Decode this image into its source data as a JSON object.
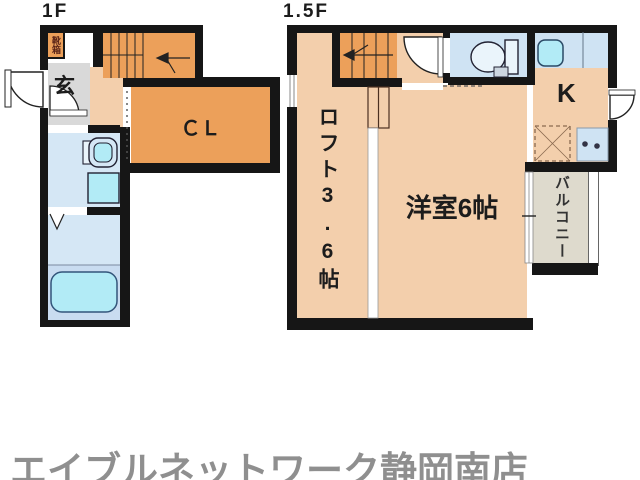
{
  "floor_1f": {
    "label": "1F",
    "entrance_label": "玄",
    "shoebox_label": "靴箱",
    "closet_label": "ＣＬ"
  },
  "floor_15f": {
    "label": "1.5F",
    "loft_label": "ロフト3.6帖",
    "room_label": "洋室6帖",
    "kitchen_label": "K",
    "balcony_label": "バルコニー"
  },
  "footer": {
    "brand": "エイブルネットワーク静岡南店"
  },
  "colors": {
    "wall": "#161616",
    "room_peach": "#f3cfac",
    "accent_orange": "#eca05a",
    "water_blue": "#d5e7f5",
    "bath_band_blue": "#c9dcf0",
    "fixture_cyan": "#b2ebf6",
    "toilet_room_blue": "#cfe3f3",
    "genkan_gray": "#d9d9d9",
    "balcony_beige": "#dedacd",
    "brand_gray": "#8f8f8f"
  }
}
